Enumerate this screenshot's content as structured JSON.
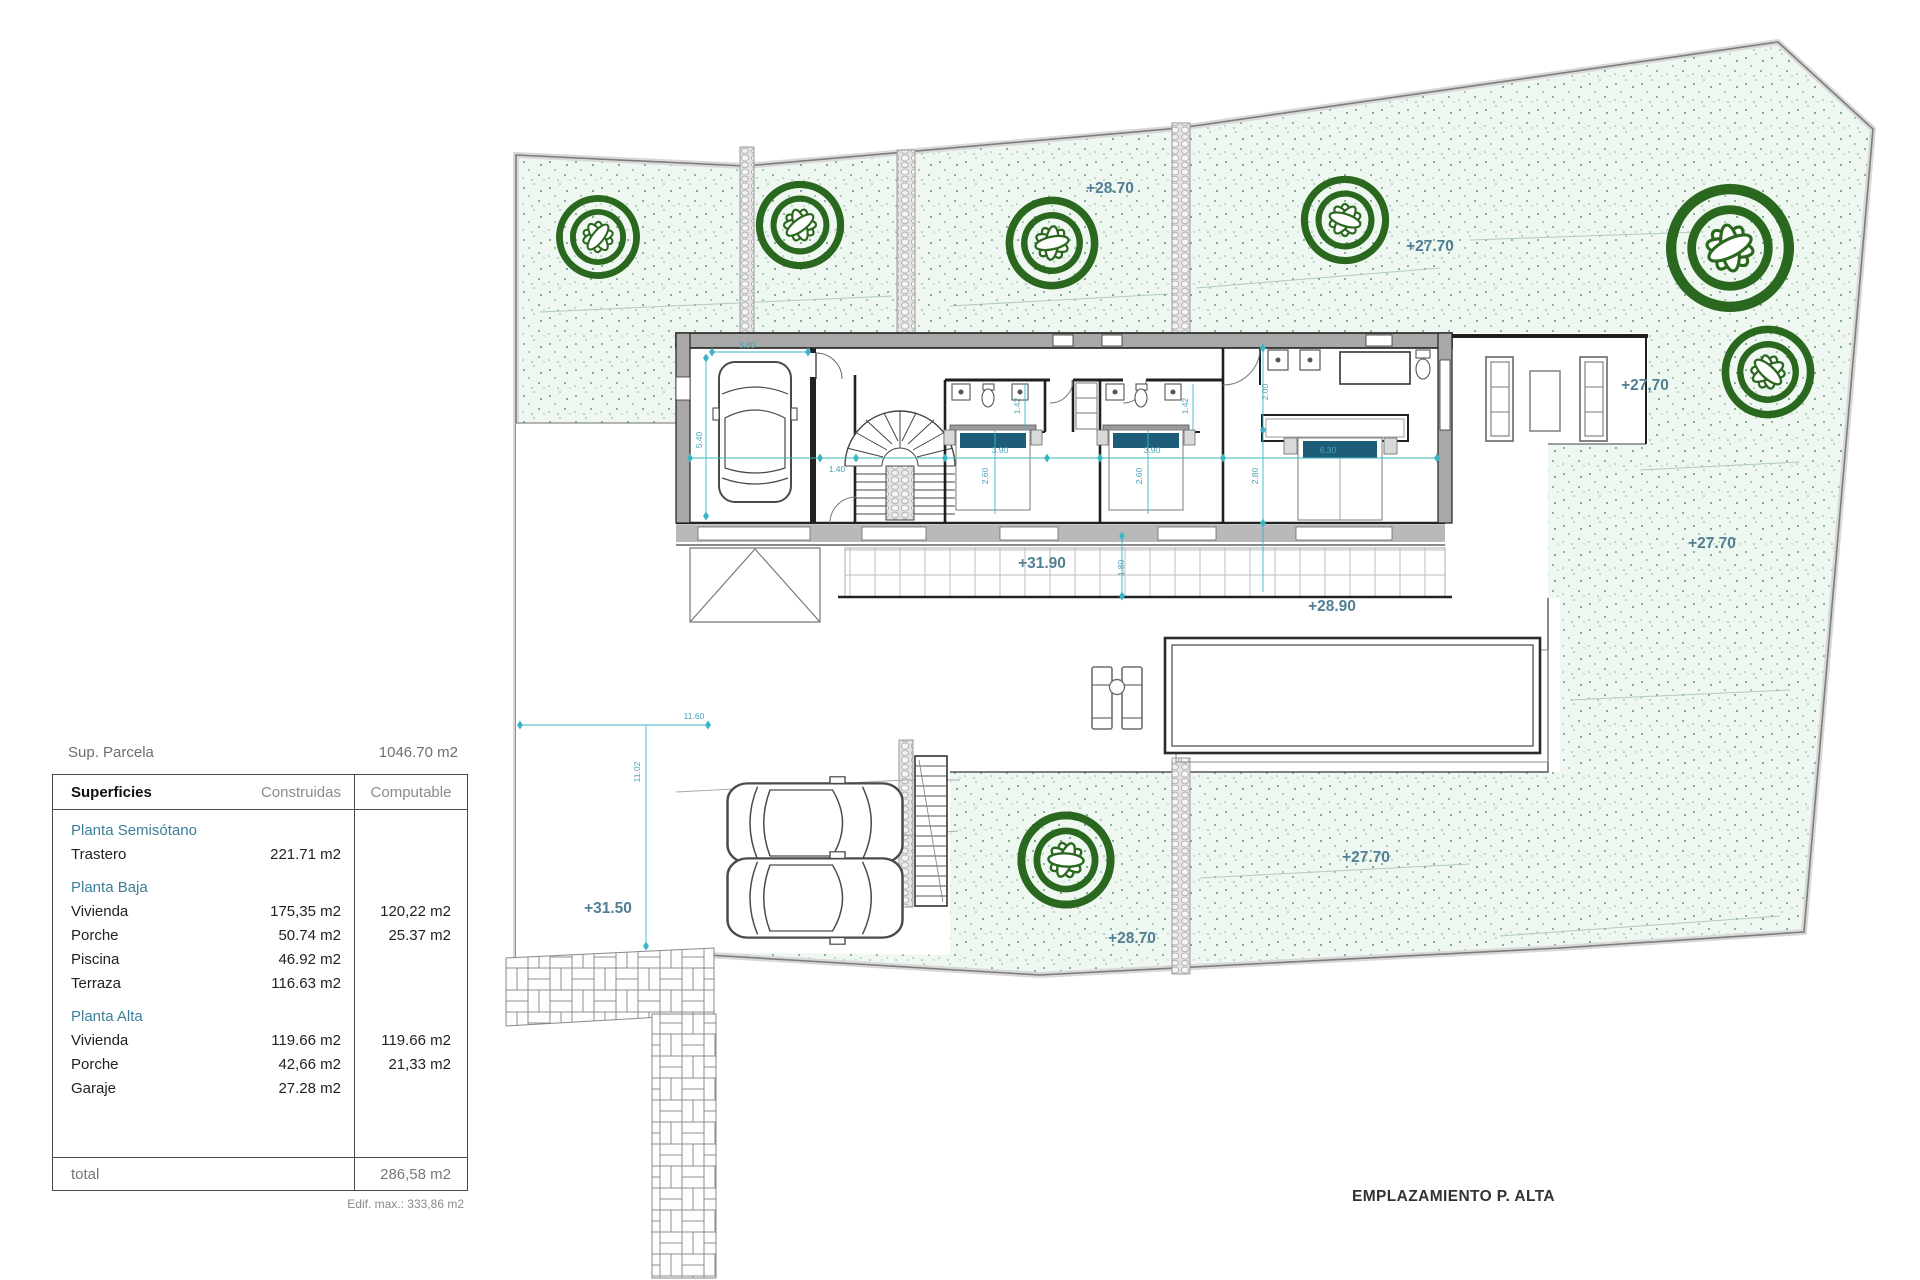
{
  "colors": {
    "accent_cyan": "#3ab5c6",
    "level_text": "#517e95",
    "plant_green": "#2b681f",
    "wall_gray": "#a8a8a8",
    "garden_bg": "#eff7f1",
    "section_teal": "#3d7f9b"
  },
  "panel": {
    "sup_label": "Sup. Parcela",
    "sup_value": "1046.70 m2",
    "headers": {
      "col1": "Superficies",
      "col2": "Construidas",
      "col3": "Computable"
    },
    "sections": [
      {
        "title": "Planta Semisótano",
        "rows": [
          {
            "label": "Trastero",
            "construidas": "221.71 m2",
            "computable": ""
          }
        ]
      },
      {
        "title": "Planta Baja",
        "rows": [
          {
            "label": "Vivienda",
            "construidas": "175,35 m2",
            "computable": "120,22 m2"
          },
          {
            "label": "Porche",
            "construidas": "50.74 m2",
            "computable": "25.37 m2"
          },
          {
            "label": "Piscina",
            "construidas": "46.92 m2",
            "computable": ""
          },
          {
            "label": "Terraza",
            "construidas": "116.63 m2",
            "computable": ""
          }
        ]
      },
      {
        "title": "Planta Alta",
        "rows": [
          {
            "label": "Vivienda",
            "construidas": "119.66 m2",
            "computable": "119.66 m2"
          },
          {
            "label": "Porche",
            "construidas": "42,66 m2",
            "computable": "21,33 m2"
          },
          {
            "label": "Garaje",
            "construidas": "27.28 m2",
            "computable": ""
          }
        ]
      }
    ],
    "total_label": "total",
    "total_value": "286,58 m2",
    "footnote": "Edif. max.: 333,86 m2"
  },
  "plan": {
    "title": "EMPLAZAMIENTO P. ALTA",
    "levels": [
      {
        "t": "+28.70"
      },
      {
        "t": "+27.70"
      },
      {
        "t": "+27,70"
      },
      {
        "t": "+27.70"
      },
      {
        "t": "+31.90"
      },
      {
        "t": "+28.90"
      },
      {
        "t": "+31.50"
      },
      {
        "t": "+28.70"
      },
      {
        "t": "+27.70"
      }
    ],
    "dims": [
      {
        "t": "3.80"
      },
      {
        "t": "5.40"
      },
      {
        "t": "1.40"
      },
      {
        "t": "3.90"
      },
      {
        "t": "2.60"
      },
      {
        "t": "1.42"
      },
      {
        "t": "3.90"
      },
      {
        "t": "2.60"
      },
      {
        "t": "1.42"
      },
      {
        "t": "6.30"
      },
      {
        "t": "2.80"
      },
      {
        "t": "2.00"
      },
      {
        "t": "1.80"
      },
      {
        "t": "11.60"
      },
      {
        "t": "11.02"
      }
    ]
  }
}
